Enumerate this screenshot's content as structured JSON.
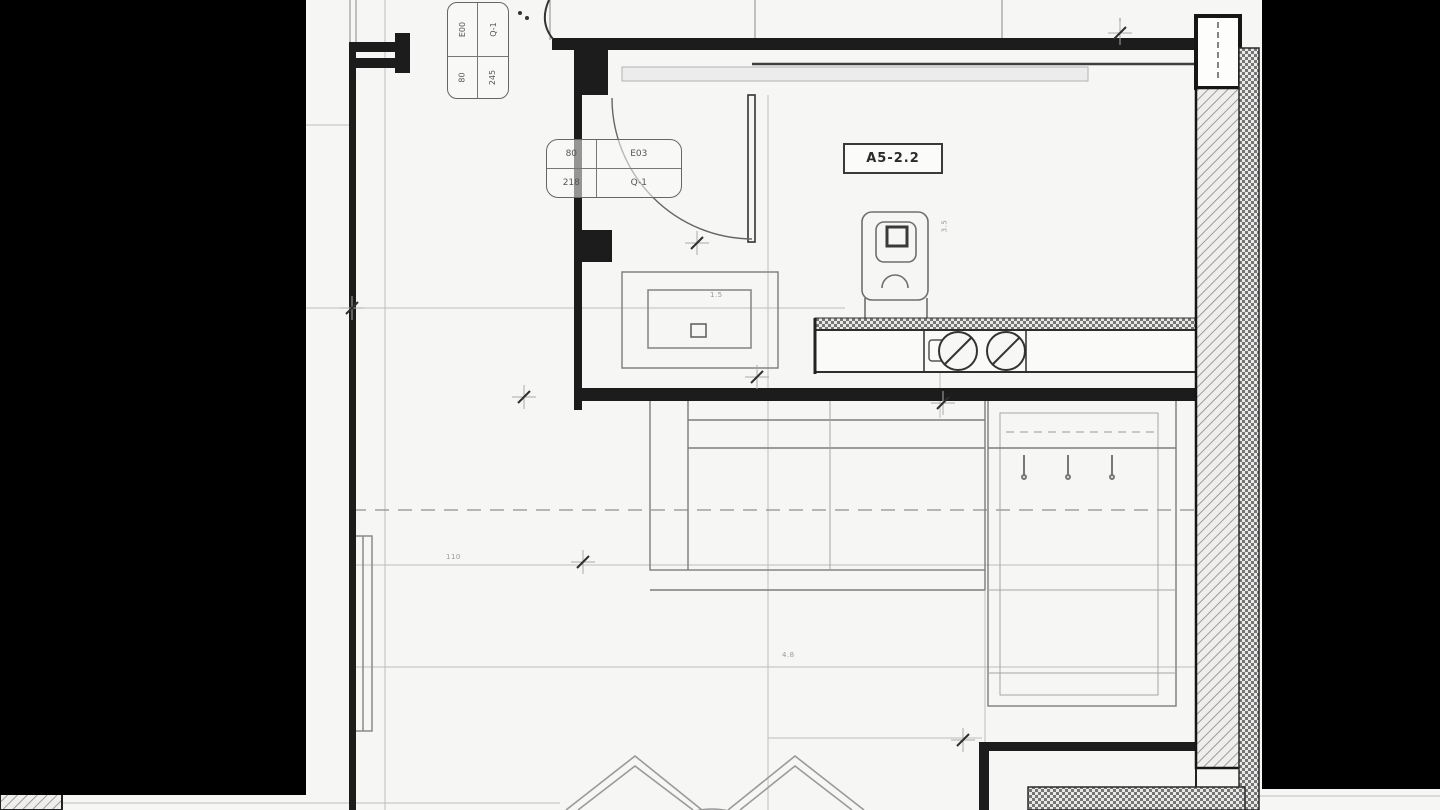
{
  "drawing": {
    "type": "architectural-floor-plan",
    "room_tag": "A5-2.2",
    "colors": {
      "paper": "#f6f6f4",
      "mask": "#000000",
      "wall": "#1c1c1c",
      "line_mid": "#7d7d7d",
      "line_light": "#bdbdbd"
    }
  },
  "schedule_tag_top": {
    "cells": {
      "top_left": "E00",
      "top_right": "Q-1",
      "bottom_left": "80",
      "bottom_right": "245"
    }
  },
  "schedule_tag_bath": {
    "cells": {
      "top_left": "80",
      "top_right": "E03",
      "bottom_left": "218",
      "bottom_right": "Q-1"
    }
  },
  "dim_labels": [
    {
      "text": "110"
    },
    {
      "text": "1.5"
    },
    {
      "text": "4.8"
    },
    {
      "text": "3.5"
    }
  ]
}
